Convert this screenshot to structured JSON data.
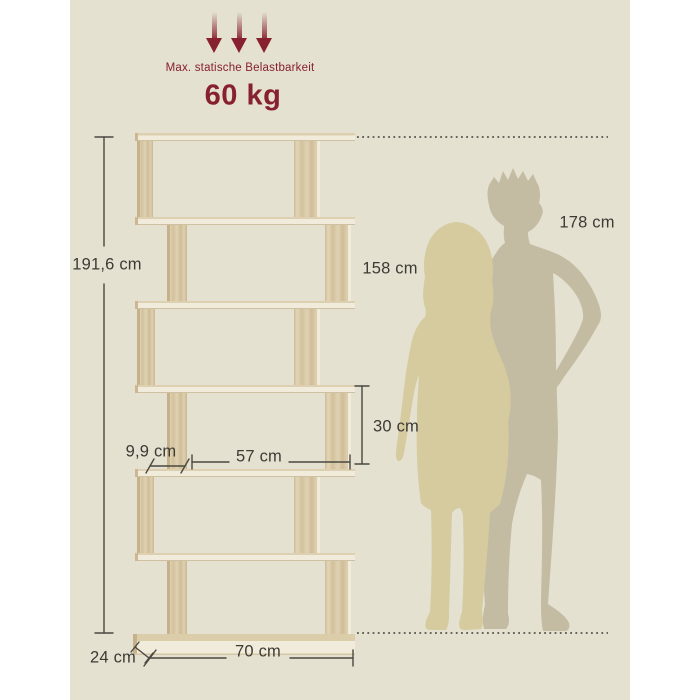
{
  "meta": {
    "description": "Product dimension diagram of a 6-tier S-shaped wooden bookshelf with two human silhouettes for scale"
  },
  "colors": {
    "scene_bg": "#e4e1d1",
    "margin": "#ffffff",
    "accent": "#87202f",
    "text": "#3c3a33",
    "line": "#4a4840",
    "dotted": "#55524a",
    "wood": "#d8c8a4",
    "edge": "#f1ebdb",
    "man": "#c4bca2",
    "woman": "#d5cb9f"
  },
  "load_info": {
    "title": "Max. statische Belastbarkeit",
    "value": "60 kg",
    "arrow_count": 3
  },
  "dimension_labels": {
    "total_height": "191,6 cm",
    "man_height": "178 cm",
    "woman_height": "158 cm",
    "compartment_height": "30 cm",
    "side_offset": "9,9 cm",
    "compartment_width": "57 cm",
    "total_width": "70 cm",
    "depth": "24 cm"
  },
  "shelf": {
    "type": "s-shaped-bookshelf",
    "tiers": 6
  }
}
